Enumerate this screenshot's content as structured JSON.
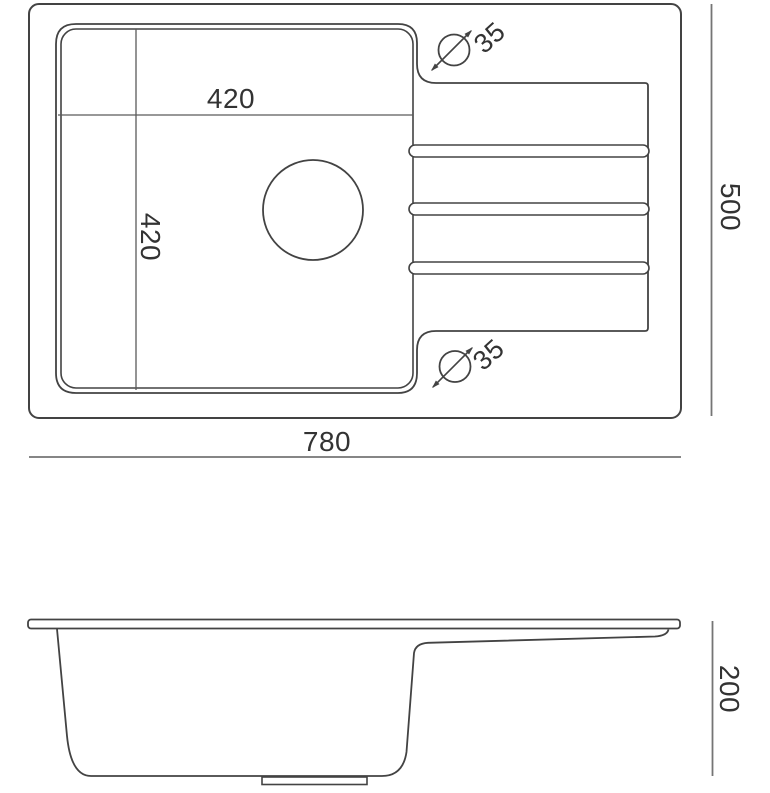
{
  "document": {
    "type": "technical-drawing",
    "subject": "kitchen sink with drainer",
    "views": [
      "top view",
      "side view"
    ]
  },
  "colors": {
    "background": "#ffffff",
    "outline": "#434343",
    "dimension_line": "#757575",
    "text": "#333333"
  },
  "top_view": {
    "labels": {
      "bowl_width": "420",
      "bowl_depth": "420",
      "overall_width": "780",
      "overall_depth": "500",
      "tap_hole_top": "35",
      "tap_hole_bottom": "35"
    }
  },
  "side_view": {
    "labels": {
      "height": "200"
    }
  }
}
